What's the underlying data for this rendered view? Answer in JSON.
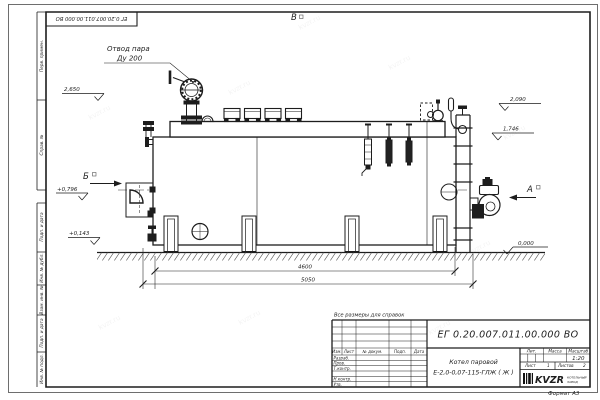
{
  "sheet": {
    "watermark": "kvzr.ru",
    "note_reference": "Все размеры для справок",
    "format_label": "Формат А3"
  },
  "margin_columns": {
    "perv_primen": "Перв. примен.",
    "sprav_no": "Справ. №",
    "podp_data_1": "Подп. и дата",
    "inv_dubl": "Инв. № дубл.",
    "vzam_inv": "Взам. инв. №",
    "podp_data_2": "Подп. и дата",
    "inv_podl": "Инв. № подл."
  },
  "drawing": {
    "callout_steam_line1": "Отвод пара",
    "callout_steam_line2": "Ду 200",
    "views": {
      "a": "А",
      "b": "Б",
      "v": "В"
    },
    "elevations": {
      "top_valve": "2,650",
      "rear_high": "2,090",
      "rear_low": "1,746",
      "front_mid": "+0,796",
      "front_low": "+0,143",
      "ground": "0,000"
    },
    "dimensions": {
      "support_span": "4600",
      "overall_length": "5050"
    }
  },
  "title_block": {
    "doc_number": "ЕГ 0.20.007.011.00.000  ВО",
    "product_line1": "Котел паровой",
    "product_line2": "Е-2,0-0,07-115-ГЛЖ ( Ж )",
    "cols": {
      "izm": "Изм.",
      "list": "Лист",
      "doc": "№ докум.",
      "podp": "Подп.",
      "data": "Дата"
    },
    "rows": {
      "razrab": "Разраб.",
      "prov": "Пров.",
      "tkontr": "Т.контр.",
      "nkontr": "Н.контр.",
      "utv": "Утв."
    },
    "lit_label": "Лит.",
    "mass_label": "Масса",
    "scale_label": "Масштаб",
    "scale_value": "1:20",
    "sheet_label": "Лист",
    "sheet_value": "1",
    "sheets_label": "Листов",
    "sheets_value": "2",
    "logo_text": "KVZR",
    "logo_sub1": "КОТЕЛЬНЫЙ",
    "logo_sub2": "ЗАВОД"
  }
}
